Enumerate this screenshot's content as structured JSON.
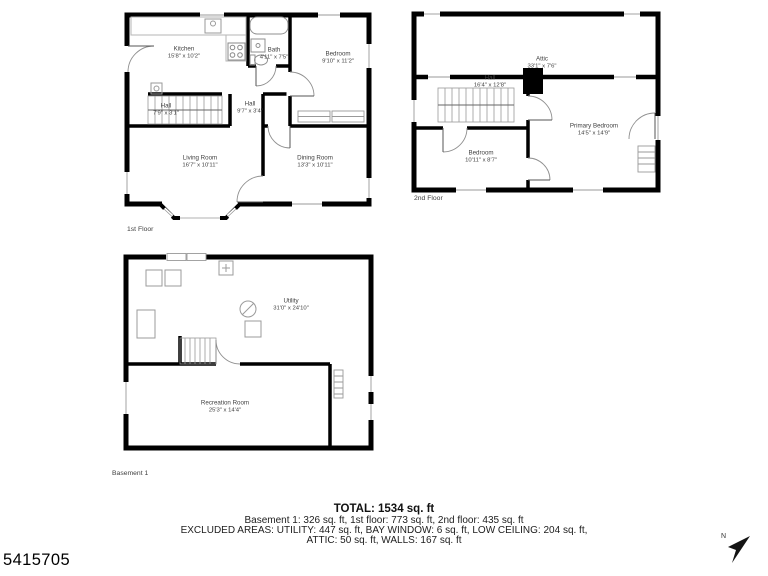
{
  "id_number": "5415705",
  "compass": {
    "label": "N"
  },
  "colors": {
    "wall": "#000000",
    "fixture": "#bdbdbd",
    "door_arc": "#8f8f8f",
    "label_text": "#3f3f3f"
  },
  "floors": [
    {
      "label": "1st Floor",
      "rooms": [
        {
          "name": "Kitchen",
          "dims": "15'8\" x 10'2\""
        },
        {
          "name": "Bath",
          "dims": "4'11\" x 7'5\""
        },
        {
          "name": "Bedroom",
          "dims": "9'10\" x 11'2\""
        },
        {
          "name": "Hall",
          "dims": "7'9\" x 3'1\""
        },
        {
          "name": "Hall",
          "dims": "9'7\" x 3'4\""
        },
        {
          "name": "Living Room",
          "dims": "16'7\" x 10'11\""
        },
        {
          "name": "Dining Room",
          "dims": "13'3\" x 10'11\""
        }
      ]
    },
    {
      "label": "2nd Floor",
      "rooms": [
        {
          "name": "Attic",
          "dims": "33'1\" x 7'6\""
        },
        {
          "name": "Hall",
          "dims": "16'4\" x 12'8\""
        },
        {
          "name": "Bedroom",
          "dims": "10'11\" x 8'7\""
        },
        {
          "name": "Primary Bedroom",
          "dims": "14'5\" x 14'9\""
        }
      ]
    },
    {
      "label": "Basement 1",
      "rooms": [
        {
          "name": "Utility",
          "dims": "31'0\" x 24'10\""
        },
        {
          "name": "Recreation Room",
          "dims": "25'3\" x 14'4\""
        }
      ]
    }
  ],
  "summary": {
    "total": "TOTAL: 1534 sq. ft",
    "line2": "Basement 1: 326 sq. ft, 1st floor: 773 sq. ft, 2nd floor: 435 sq. ft",
    "line3": "EXCLUDED AREAS: UTILITY: 447 sq. ft, BAY WINDOW: 6 sq. ft, LOW CEILING: 204 sq. ft,",
    "line4": "ATTIC: 50 sq. ft, WALLS: 167 sq. ft"
  }
}
